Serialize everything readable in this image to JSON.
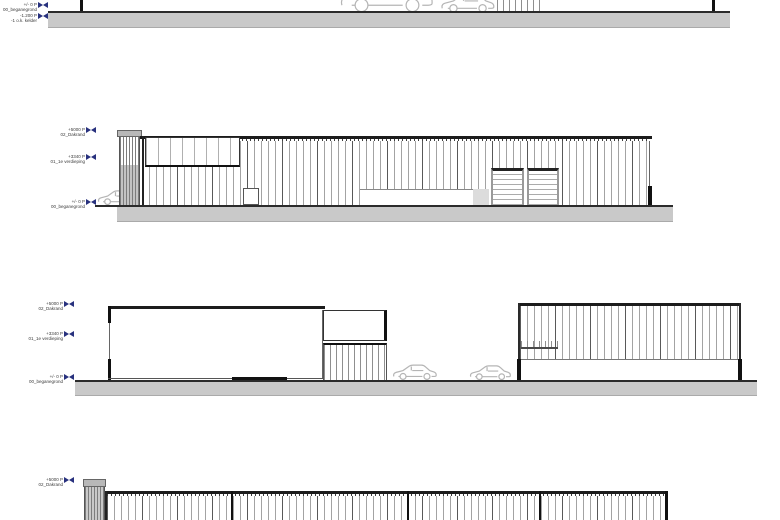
{
  "colors": {
    "ground_fill": "#c9c9c9",
    "drawing_line": "#1c1c1c",
    "level_marker": "#28317e",
    "car_outline": "#b5b5b5"
  },
  "elevations": [
    {
      "levels": [
        {
          "value": "+/- 0 P",
          "name": "00_beganegrond"
        },
        {
          "value": "-1.200 P",
          "name": "-1 o.k. kelder"
        }
      ]
    },
    {
      "levels": [
        {
          "value": "+5000 P",
          "name": "02_Dakrand"
        },
        {
          "value": "+3340 P",
          "name": "01_1e verdieping"
        },
        {
          "value": "+/- 0 P",
          "name": "00_beganegrond"
        }
      ]
    },
    {
      "levels": [
        {
          "value": "+5000 P",
          "name": "02_Dakrand"
        },
        {
          "value": "+3340 P",
          "name": "01_1e verdieping"
        },
        {
          "value": "+/- 0 P",
          "name": "00_beganegrond"
        }
      ]
    },
    {
      "levels": [
        {
          "value": "+5000 P",
          "name": "02_Dakrand"
        }
      ]
    }
  ]
}
